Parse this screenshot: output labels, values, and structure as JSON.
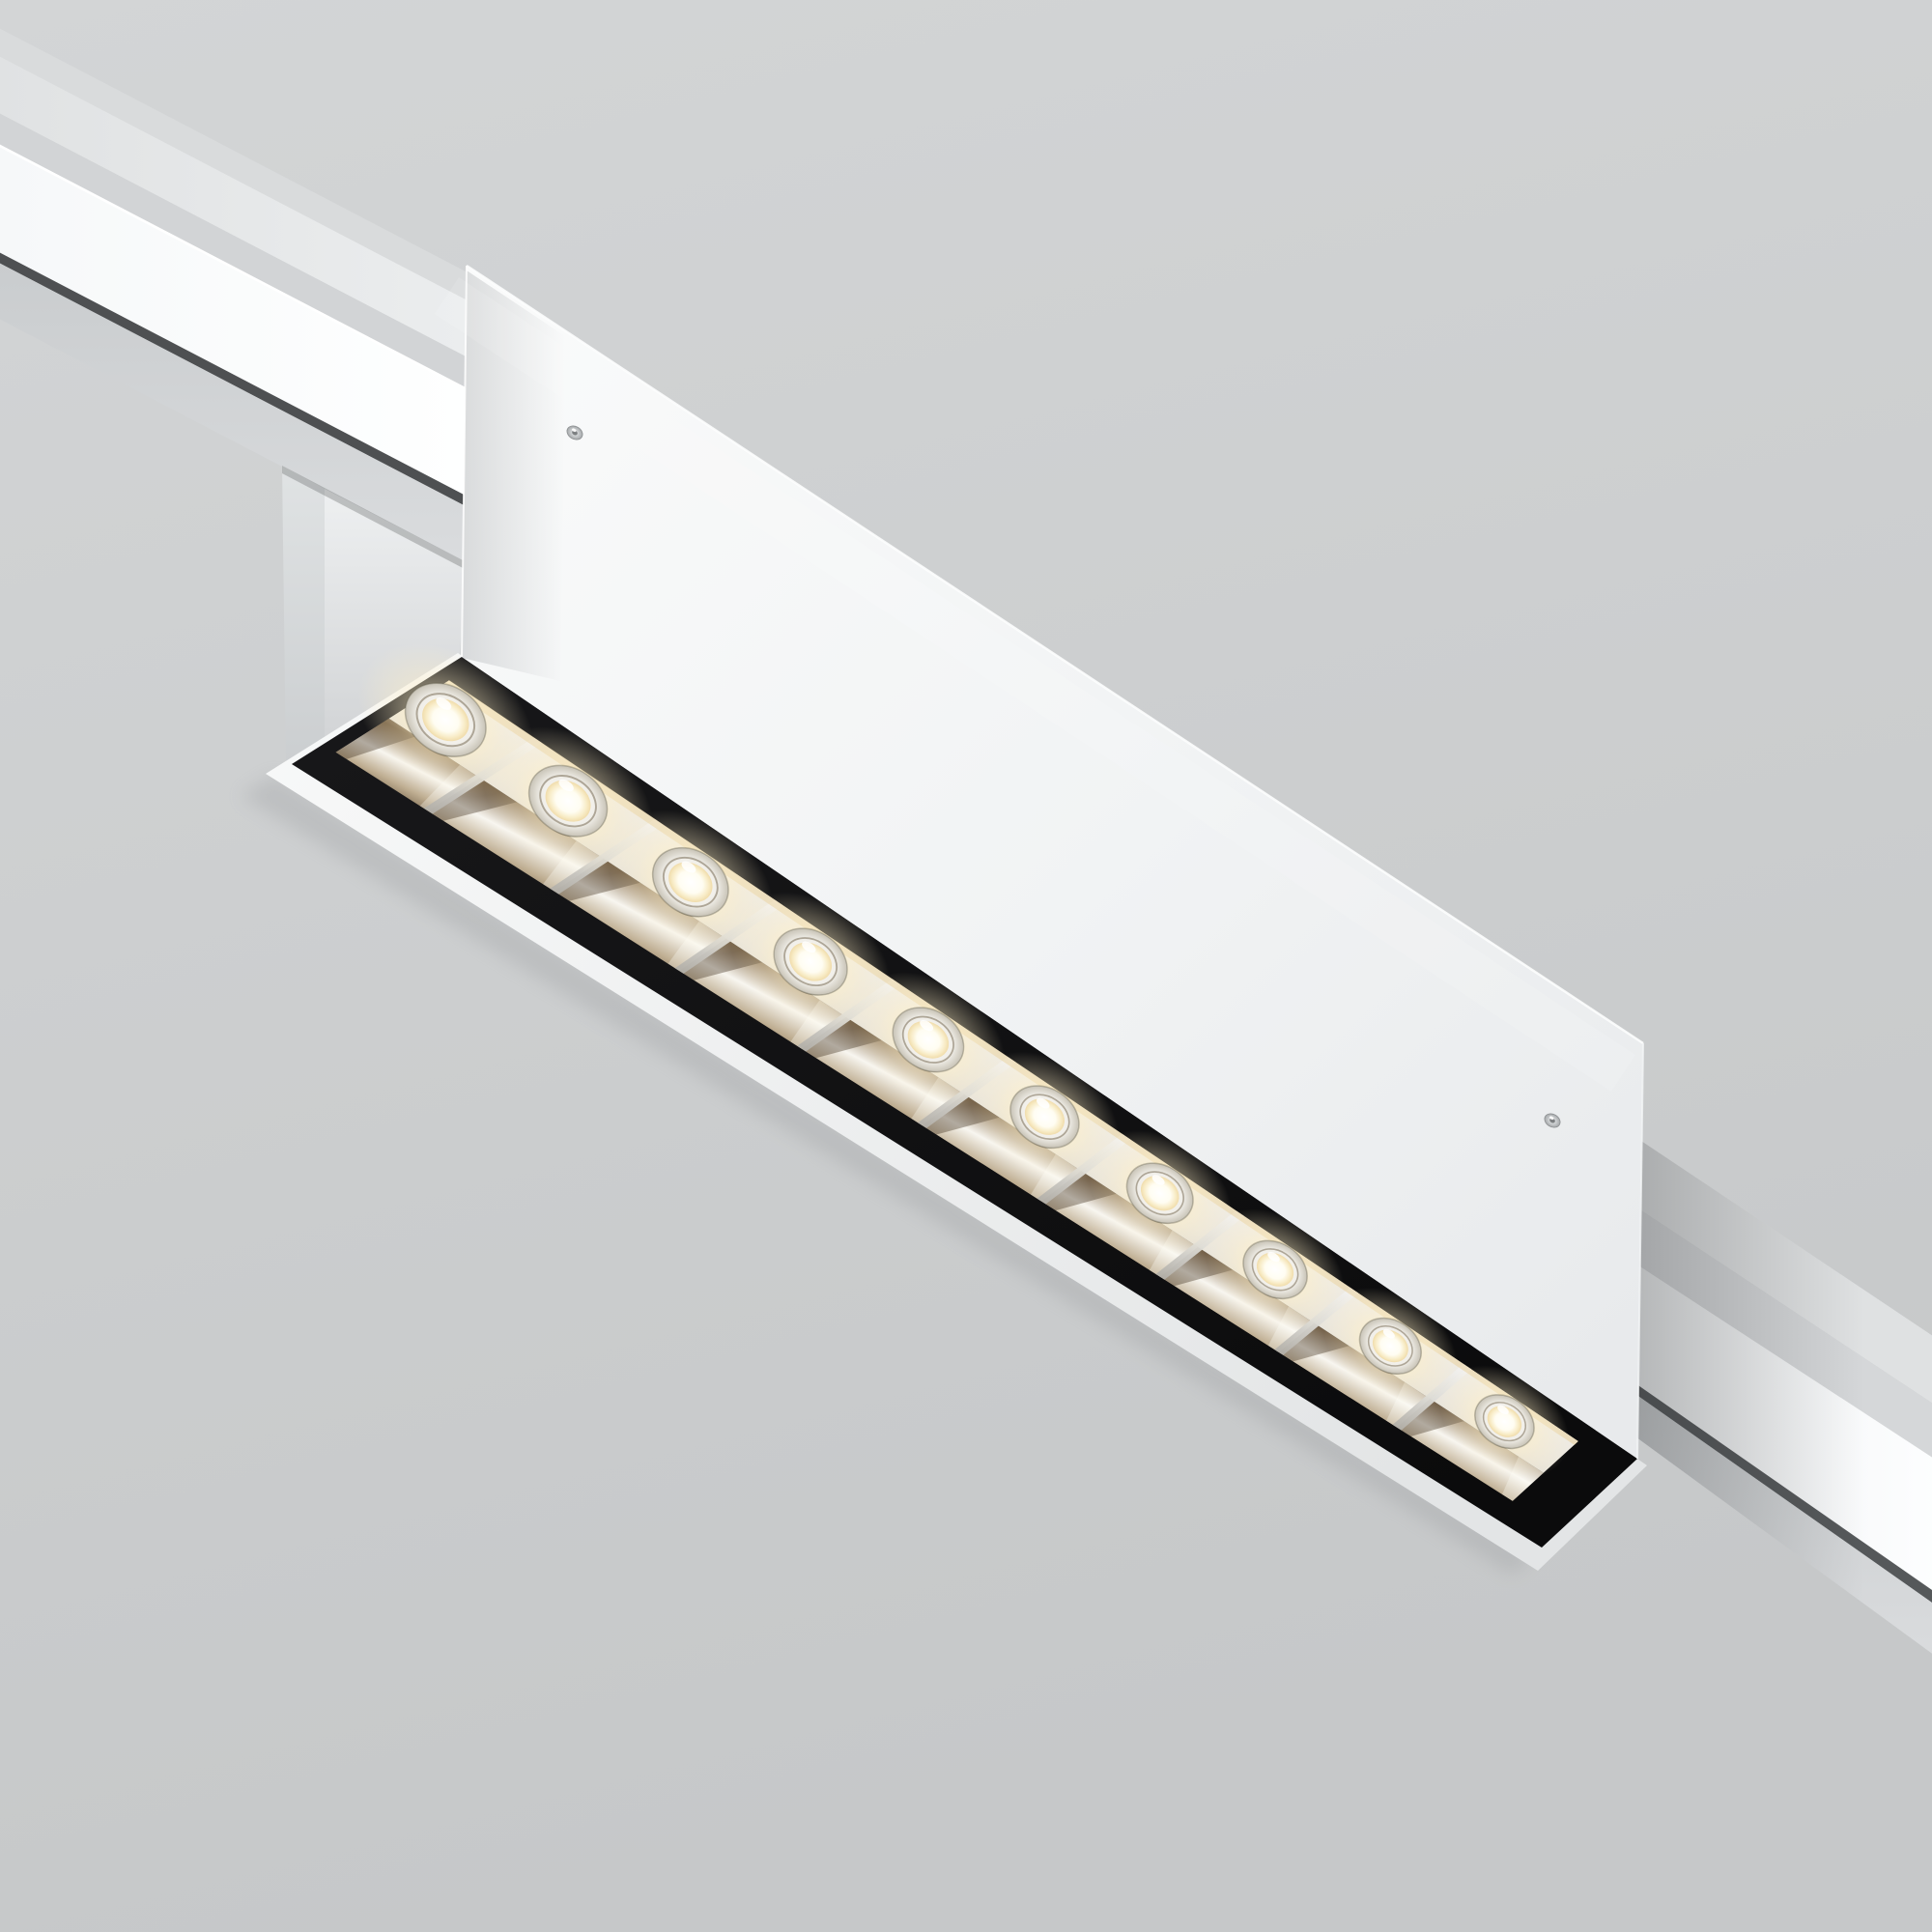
{
  "scene": {
    "kind": "3d-product-render",
    "description": "White linear LED track spotlight with a black louver of ten chrome reflector cells, mounted on a white magnetic track rail running diagonally, lights on, viewed from below",
    "background_top": "#d3d5d6",
    "background_bottom": "#c6c8c9"
  },
  "track": {
    "name": "track-rail",
    "body_color": "#e1e3e4",
    "upper_strip_color": "#d9dbdc",
    "facet_color": "#d2d4d6",
    "lit_channel_color": "#fbfcfd",
    "groove_color": "#4e5052",
    "flange_color": "#cdd0d2"
  },
  "fixture": {
    "name": "linear-track-spotlight",
    "housing_color": "#f3f4f5",
    "stem_color": "#e4e6e8",
    "louver_frame_color": "#0b0b0c",
    "rim_color": "#f6f7f7",
    "reflector_finish": "polished chrome with warm bronze reflections",
    "reflector_bright": "#f8f6f0",
    "reflector_bronze": "#82694a",
    "reflector_dark": "#2c2216",
    "separator_color": "#eceeec",
    "screw_count": 2,
    "screw_color": "#c7cacc"
  },
  "lights": {
    "count": 10,
    "state": "on",
    "core_color": "#ffffff",
    "warm_ring_color": "#f0dcab",
    "glow_color": "#fff3d4"
  }
}
